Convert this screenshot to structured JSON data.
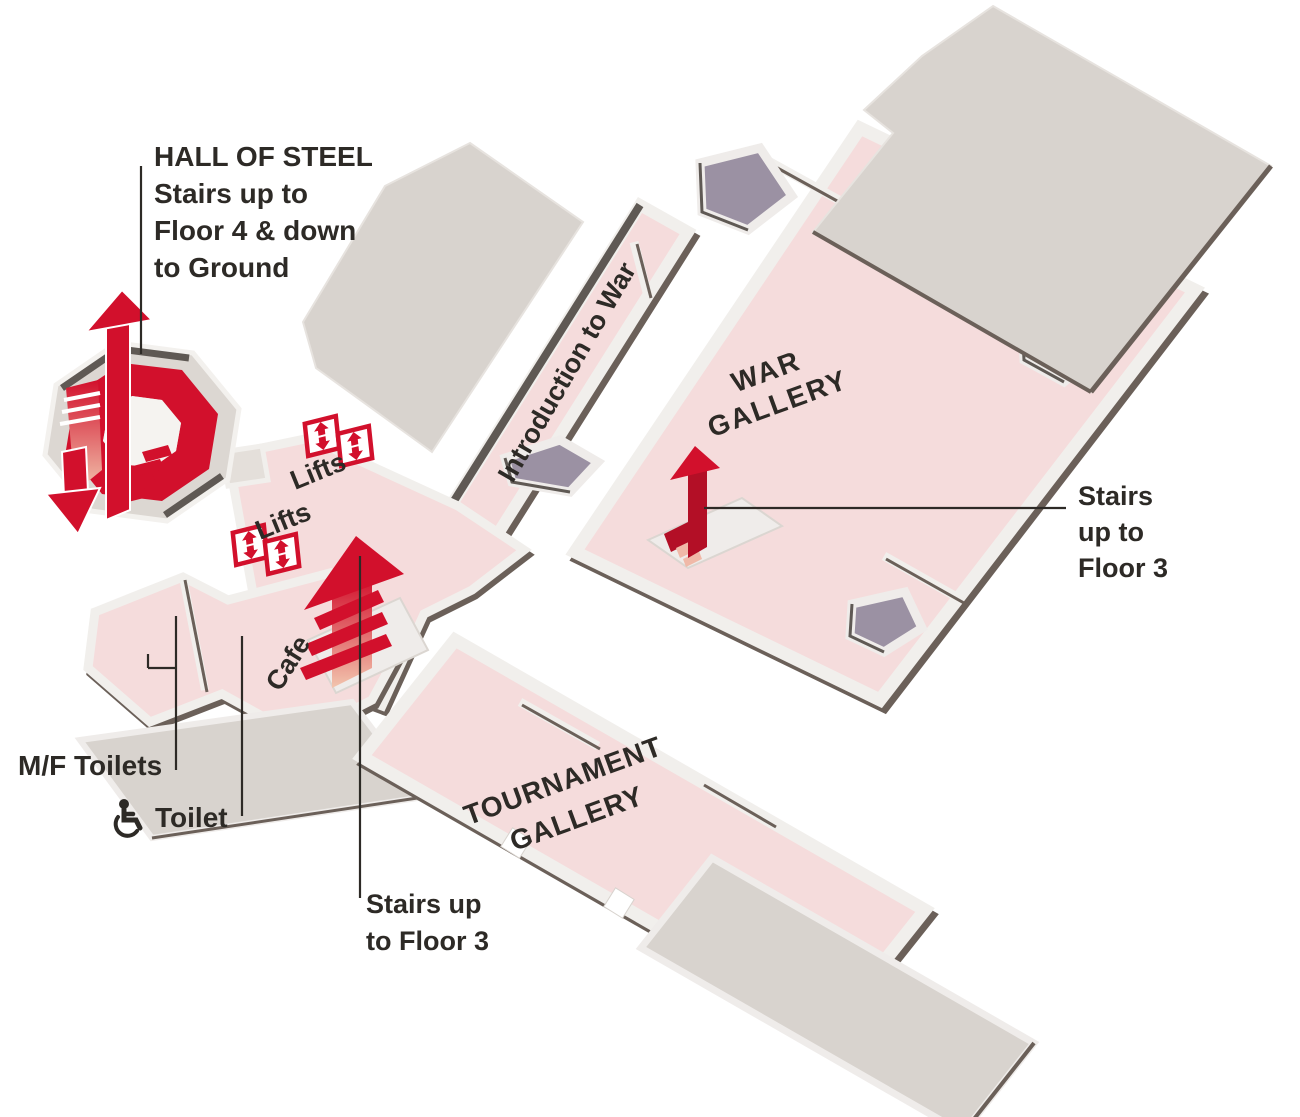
{
  "labels": {
    "hall_of_steel": {
      "line1": "HALL OF STEEL",
      "line2": "Stairs up to",
      "line3": "Floor 4 & down",
      "line4": "to Ground"
    },
    "introduction_to_war": "Introduction to War",
    "war_gallery": {
      "line1": "WAR",
      "line2": "GALLERY"
    },
    "tournament_gallery": {
      "line1": "TOURNAMENT",
      "line2": "GALLERY"
    },
    "lifts_upper": "Lifts",
    "lifts_lower": "Lifts",
    "cafe": "Cafe",
    "mf_toilets": "M/F Toilets",
    "accessible_toilet": "Toilet",
    "stairs_war_gallery": {
      "line1": "Stairs",
      "line2": "up to",
      "line3": "Floor 3"
    },
    "stairs_tournament": {
      "line1": "Stairs up",
      "line2": "to Floor 3"
    }
  },
  "icons": {
    "lift": "lift-up-down-arrows-icon",
    "wheelchair": "wheelchair-icon",
    "spiral_stairs": "spiral-staircase-icon",
    "stairs_up_arrow": "stairs-up-arrow-icon",
    "stairs_down_arrow": "stairs-down-arrow-icon"
  },
  "colors": {
    "background": "#ffffff",
    "floor_pink": "#f5dcdc",
    "roof_gray": "#d8d3ce",
    "wall_light": "#f1efec",
    "wall_dark": "#5f5954",
    "stair_void_purple": "#9b91a3",
    "accent_red": "#d2102c",
    "accent_red_dark": "#b30f26",
    "gradient_pale": "#f2c5ae",
    "text": "#2d2a26"
  }
}
